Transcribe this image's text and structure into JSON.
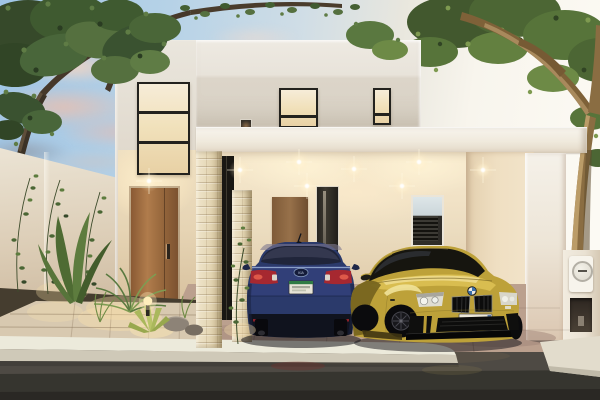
{
  "scene": {
    "description": "Dusk exterior architectural rendering: modern two-storey white house with open double carport, blue sedan (rear view) and yellow sports coupe (front view) parked inside, wooden entry door, landscaped garden with path lights, flanking trees and street in foreground",
    "time_of_day": "dusk",
    "texts": {
      "kia_badge": "KIA",
      "bmw_plate": "1SB-652-B"
    },
    "vehicles": {
      "left_car": {
        "type": "sedan, rear view",
        "badge": "KIA",
        "body_color": "#2b3a6b",
        "plate_style": "white with green band"
      },
      "right_car": {
        "type": "sports coupe, front three-quarter view",
        "badge": "BMW roundel",
        "body_color": "#c3a43a",
        "plate_text": "1SB-652-B"
      }
    },
    "palette": {
      "sky_blue": "#a6c9e6",
      "sky_white": "#fdfbf5",
      "cloud_pink": "#e8c4b4",
      "wall_white": "#e9e5dc",
      "wall_shade": "#d5cabb",
      "warm_interior_light": "#f4e3c2",
      "stone_pillar": "#e6dabc",
      "wood_door": "#9c6b40",
      "window_frame": "#23221e",
      "driveway": "#b99e8d",
      "street": "#45423d",
      "curb": "#eceadb",
      "foliage_dark": "#36492a",
      "foliage_light": "#6d8a46",
      "trunk_lit": "#a8895c",
      "taillight_red": "#a62830",
      "headlight_white": "#efefe6"
    },
    "elements": [
      "left tree",
      "right tree",
      "low garden wall",
      "entry door",
      "tall entry window",
      "upper floor windows",
      "carport fascia",
      "recessed ceiling downlights",
      "stone clad pillars",
      "garden plants",
      "bollard path light",
      "electric meter pillar",
      "stone walkway",
      "white curb",
      "asphalt street"
    ]
  }
}
